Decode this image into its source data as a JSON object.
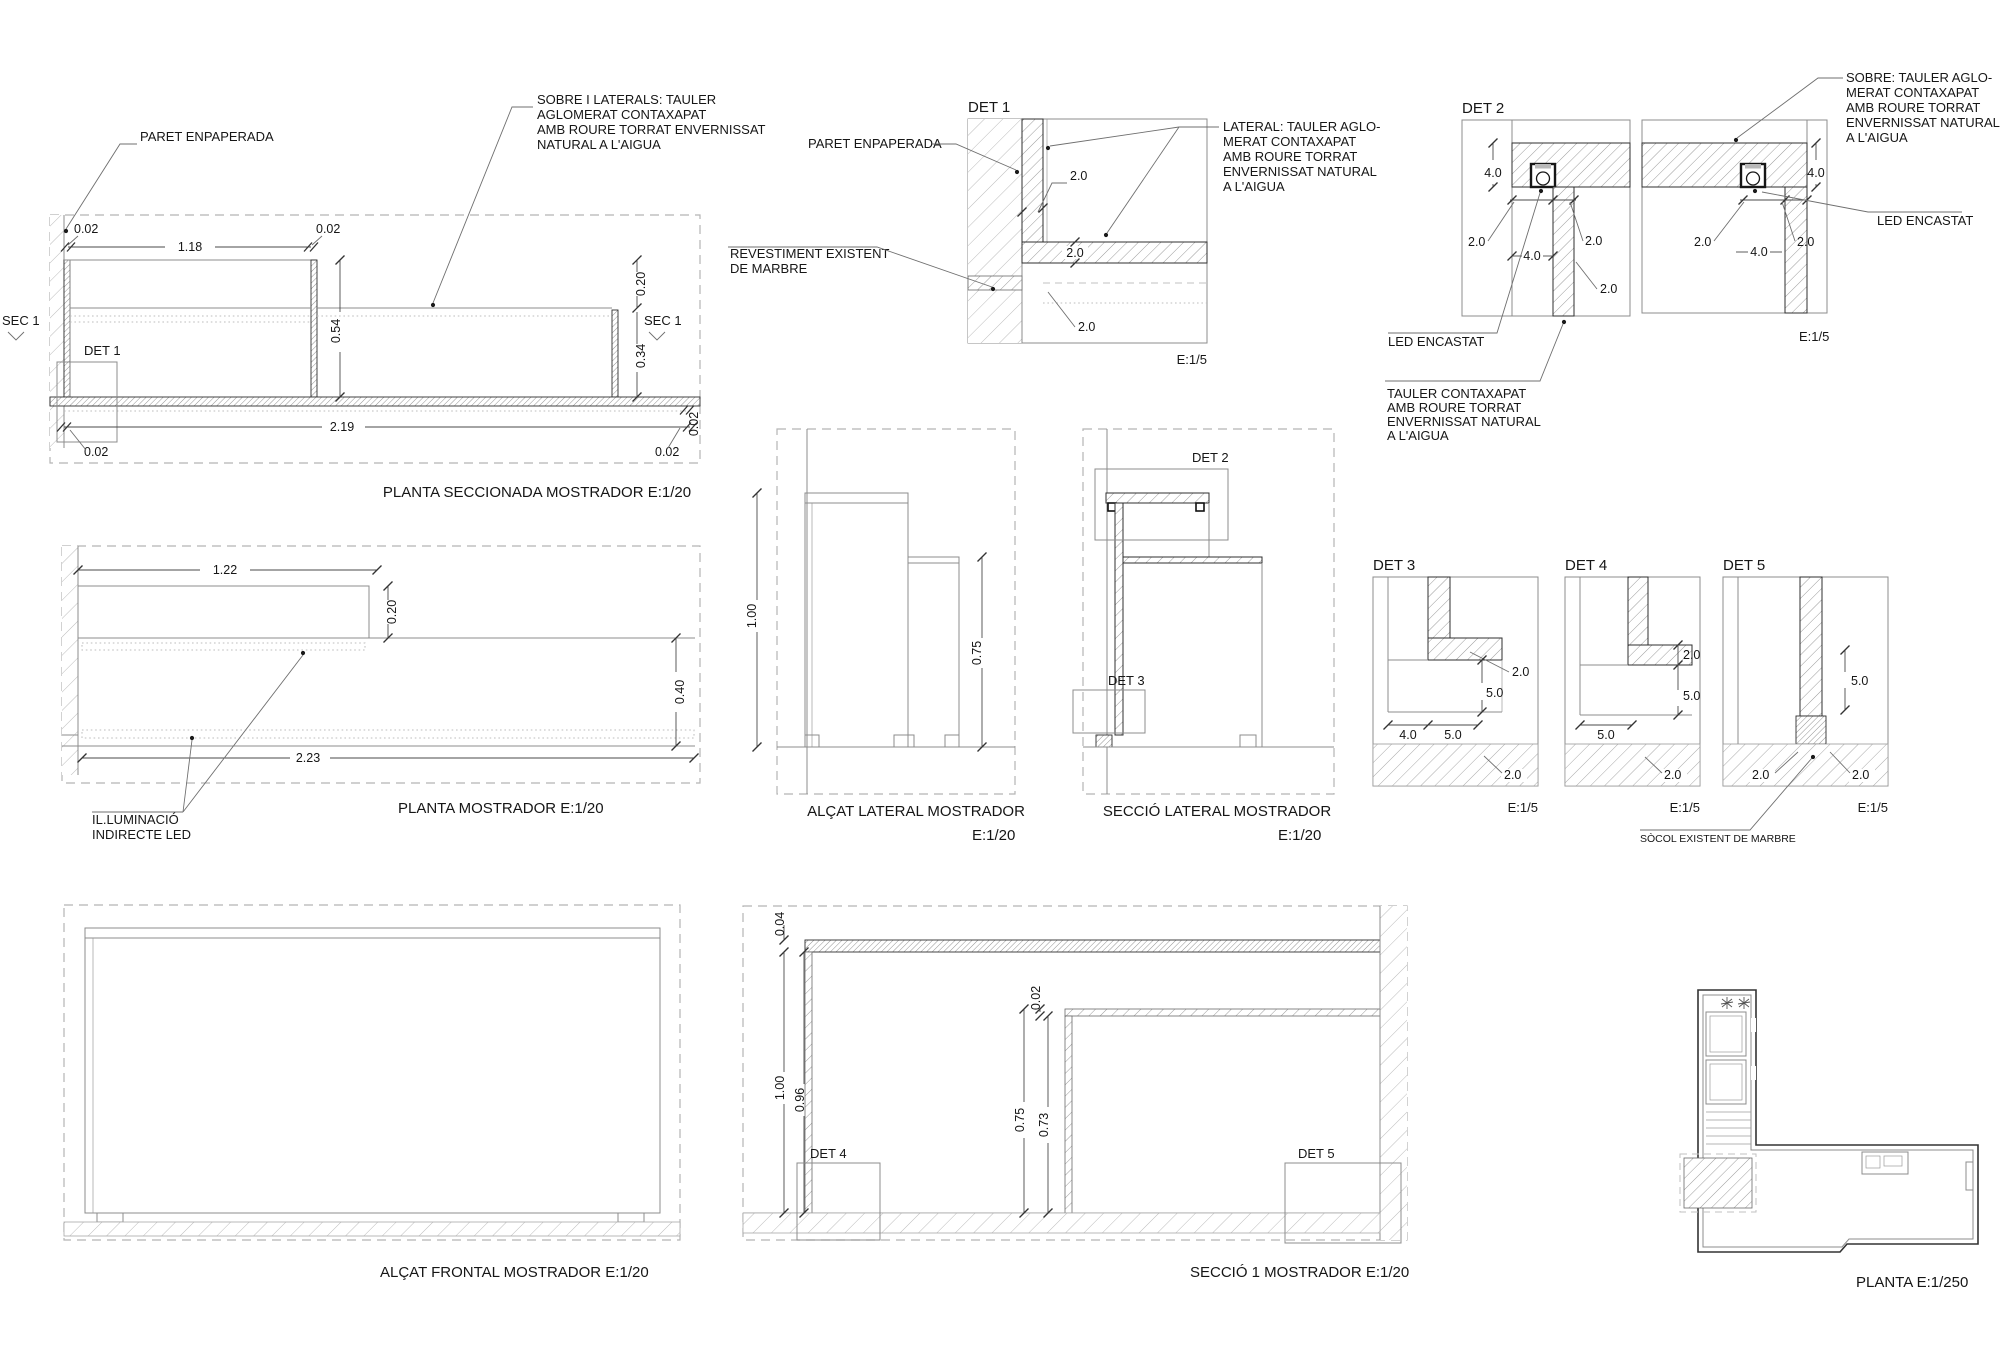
{
  "sheet": {
    "background": "#ffffff",
    "line_color": "#8c8c8c",
    "dark_line_color": "#2e2e2e",
    "text_color": "#161616"
  },
  "panels": {
    "p1": {
      "caption": "PLANTA SECCIONADA MOSTRADOR  E:1/20",
      "det_label": "DET 1",
      "sec_left": "SEC 1",
      "sec_right": "SEC 1",
      "paret": "PARET ENPAPERADA",
      "note_sobre": [
        "SOBRE I LATERALS: TAULER",
        "AGLOMERAT CONTAXAPAT",
        "AMB ROURE TORRAT ENVERNISSAT",
        "NATURAL A L'AIGUA"
      ],
      "dims": [
        "0.02",
        "1.18",
        "0.02",
        "0.20",
        "0.54",
        "0.34",
        "2.19",
        "0.02",
        "0.02",
        "0.02"
      ]
    },
    "det1": {
      "title": "DET 1",
      "scale": "E:1/5",
      "paret": "PARET ENPAPERADA",
      "note_marbre": [
        "REVESTIMENT EXISTENT",
        "DE MARBRE"
      ],
      "note_lateral": [
        "LATERAL: TAULER AGLO-",
        "MERAT CONTAXAPAT",
        "AMB ROURE TORRAT",
        "ENVERNISSAT NATURAL",
        "A L'AIGUA"
      ],
      "dims": [
        "2.0",
        "2.0",
        "2.0"
      ]
    },
    "det2": {
      "title": "DET 2",
      "scale": "E:1/5",
      "led_left": "LED ENCASTAT",
      "led_right": "LED ENCASTAT",
      "note_sobre": [
        "SOBRE: TAULER AGLO-",
        "MERAT CONTAXAPAT",
        "AMB ROURE TORRAT",
        "ENVERNISSAT NATURAL",
        "A L'AIGUA"
      ],
      "note_tauler": [
        "TAULER CONTAXAPAT",
        "AMB ROURE TORRAT",
        "ENVERNISSAT NATURAL",
        "A L'AIGUA"
      ],
      "dims_left": [
        "4.0",
        "2.0",
        "4.0",
        "2.0",
        "2.0"
      ],
      "dims_right": [
        "4.0",
        "2.0",
        "4.0",
        "2.0"
      ]
    },
    "p4": {
      "caption": "PLANTA MOSTRADOR  E:1/20",
      "note_llum": [
        "IL.LUMINACIÓ",
        "INDIRECTE LED"
      ],
      "dims": [
        "1.22",
        "0.20",
        "0.40",
        "2.23"
      ]
    },
    "p5": {
      "caption": "ALÇAT LATERAL MOSTRADOR",
      "scale": "E:1/20",
      "dims": [
        "1.00",
        "0.75"
      ]
    },
    "p6": {
      "caption": "SECCIÓ LATERAL MOSTRADOR",
      "scale": "E:1/20",
      "det2": "DET 2",
      "det3": "DET 3"
    },
    "det3": {
      "title": "DET 3",
      "scale": "E:1/5",
      "dims": [
        "2.0",
        "5.0",
        "4.0",
        "5.0",
        "2.0"
      ]
    },
    "det4": {
      "title": "DET 4",
      "scale": "E:1/5",
      "dims": [
        "2.0",
        "5.0",
        "5.0",
        "2.0"
      ]
    },
    "det5": {
      "title": "DET 5",
      "scale": "E:1/5",
      "dims": [
        "5.0",
        "2.0",
        "2.0"
      ]
    },
    "socol": "SÒCOL EXISTENT DE MARBRE",
    "p10": {
      "caption": "ALÇAT FRONTAL MOSTRADOR  E:1/20"
    },
    "p11": {
      "caption": "SECCIÓ 1  MOSTRADOR  E:1/20",
      "det4": "DET 4",
      "det5": "DET 5",
      "dims": [
        "0.04",
        "1.00",
        "0.96",
        "0.02",
        "0.75",
        "0.73"
      ]
    },
    "p12": {
      "caption": "PLANTA E:1/250"
    }
  }
}
